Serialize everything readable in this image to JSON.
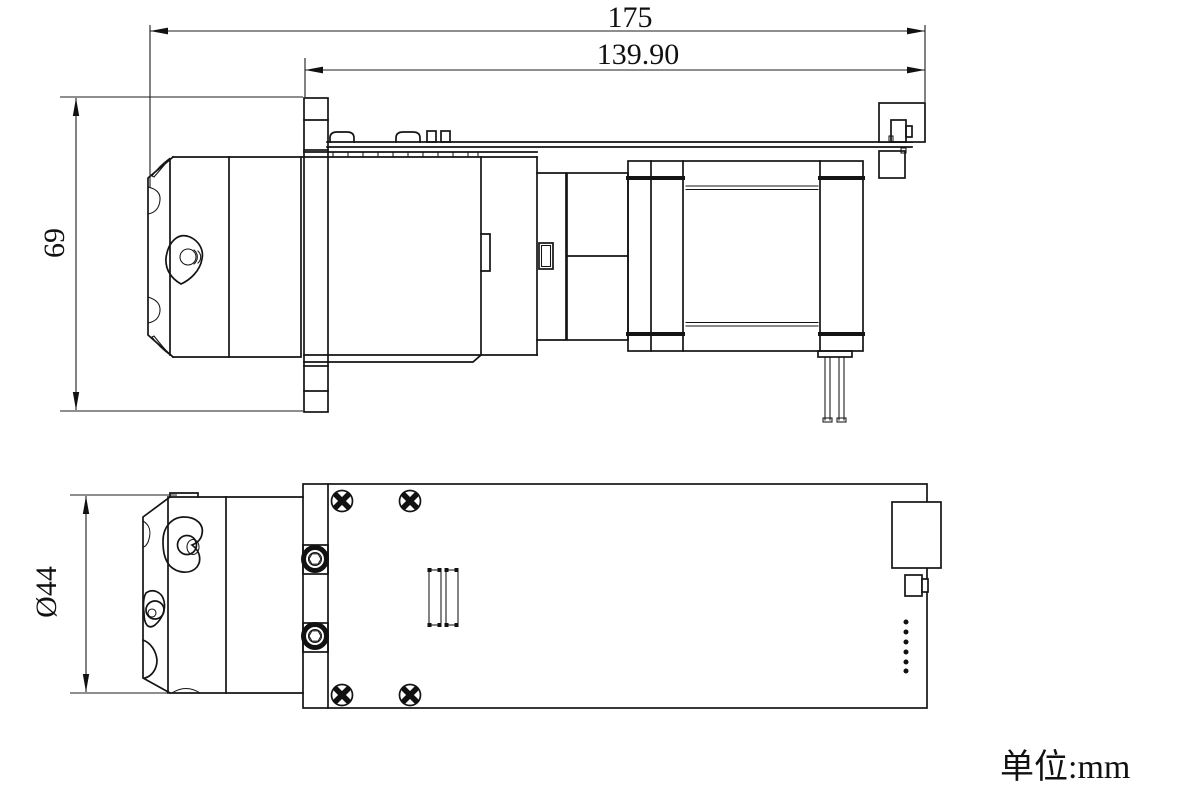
{
  "drawing": {
    "dimensions": {
      "overall_length": "175",
      "mount_length": "139.90",
      "overall_height": "69",
      "head_diameter": "Ø44"
    },
    "unit_note": "单位:mm",
    "colors": {
      "line": "#141414",
      "background": "#ffffff"
    }
  }
}
